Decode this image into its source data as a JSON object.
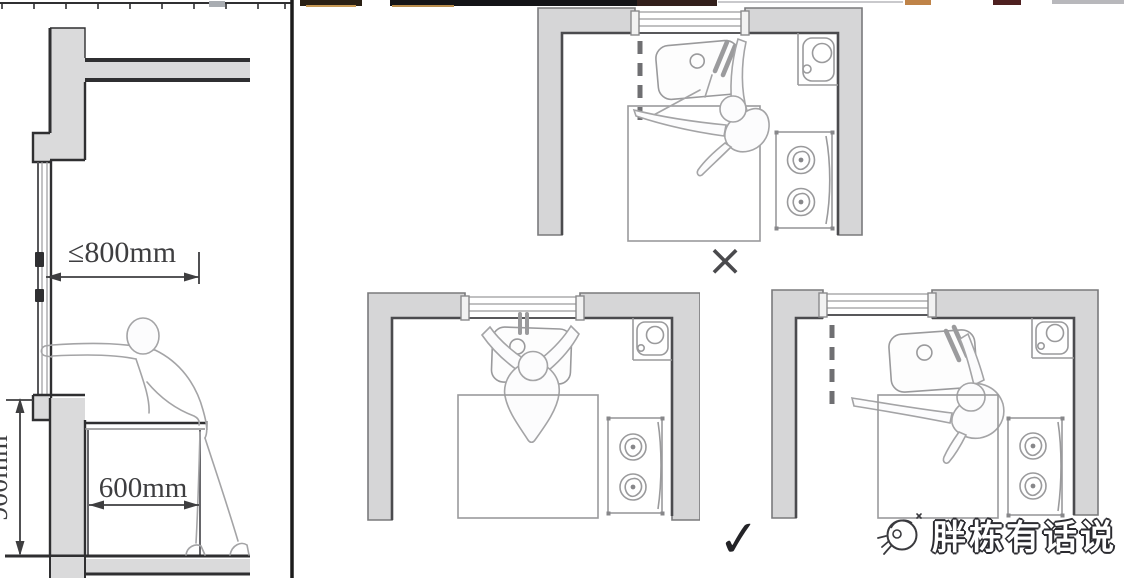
{
  "colors": {
    "background": "#ffffff",
    "wall-fill": "#d6d6d7",
    "wall-edge": "#7a7a7c",
    "line-dark": "#4b4b4e",
    "concrete-fill": "#dadadb",
    "concrete-edge": "#2f2f31",
    "furniture-line": "#9a9a9c",
    "person-line": "#a4a4a6",
    "dash-line": "#6f6f72",
    "dim-line": "#3e3e40",
    "mark-wrong": "#4a4a4d",
    "mark-right": "#232327",
    "logo-text-fill": "#ffffff",
    "logo-text-outline": "#2b2b30"
  },
  "section_view": {
    "title": "kitchen-window-reach-section",
    "reach_label": "≤800mm",
    "counter_depth_label": "600mm",
    "sill_height_label": "900mm"
  },
  "plans": {
    "top": {
      "id": "plan-top",
      "verdict": "wrong"
    },
    "bottom_left": {
      "id": "plan-bottom-left",
      "verdict": "right"
    },
    "bottom_right": {
      "id": "plan-bottom-right",
      "verdict": "right"
    }
  },
  "marks": {
    "wrong": "×",
    "right": "✓"
  },
  "logo": {
    "text": "胖栋有话说",
    "icon": "sketch-mascot-icon"
  }
}
